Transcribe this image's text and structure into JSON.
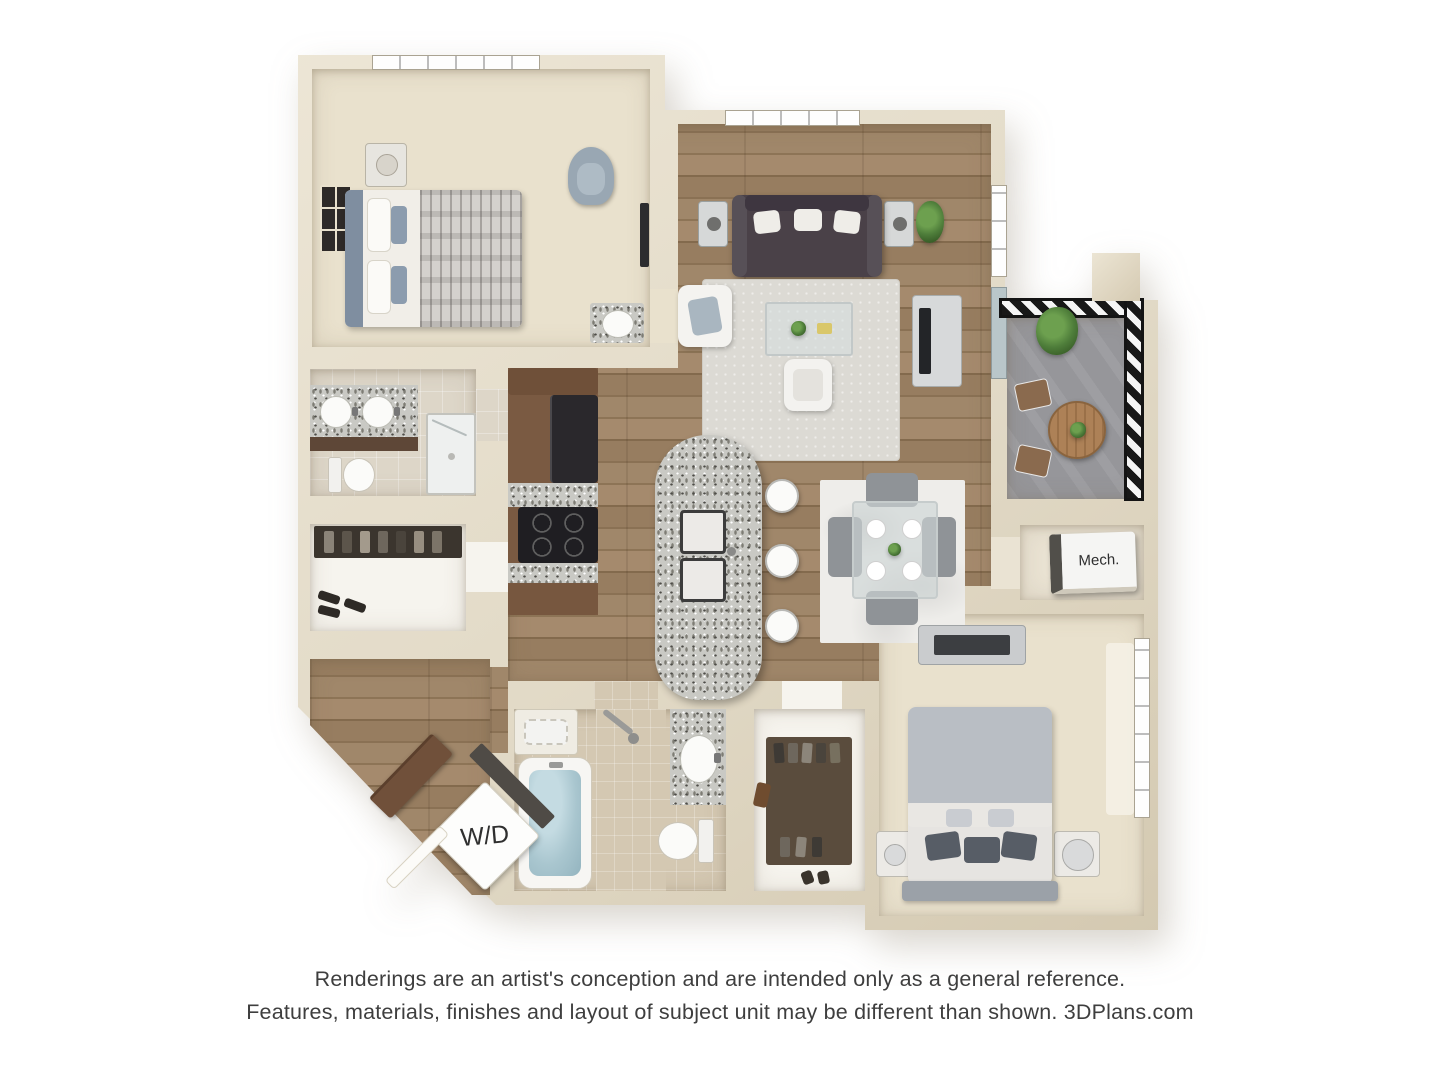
{
  "plan": {
    "labels": {
      "washer_dryer": "W/D",
      "mechanical": "Mech."
    }
  },
  "disclaimer": {
    "line1": "Renderings are an artist's conception and are intended only as a general reference.",
    "line2": "Features, materials, finishes and layout of subject unit may be different than shown. 3DPlans.com"
  },
  "palette": {
    "background": "#ffffff",
    "wall": "#e2dac7",
    "wall_shade": "#cfc5ae",
    "wood_floor": "#967d5f",
    "carpet": "#e9e1cd",
    "bath_tile": "#ddd6c8",
    "bath2_tile": "#d4c8b2",
    "closet_floor": "#f6f4ee",
    "balcony_floor": "#96969a",
    "railing": "#181818",
    "sofa": "#4a4148",
    "cabinet_brown": "#7a5a42",
    "appliance_black": "#26242a",
    "bedding_gray": "#b9bec4",
    "water_blue": "#a9c6cf",
    "plant_green": "#4e7d3a",
    "text": "#3e3e3e"
  }
}
